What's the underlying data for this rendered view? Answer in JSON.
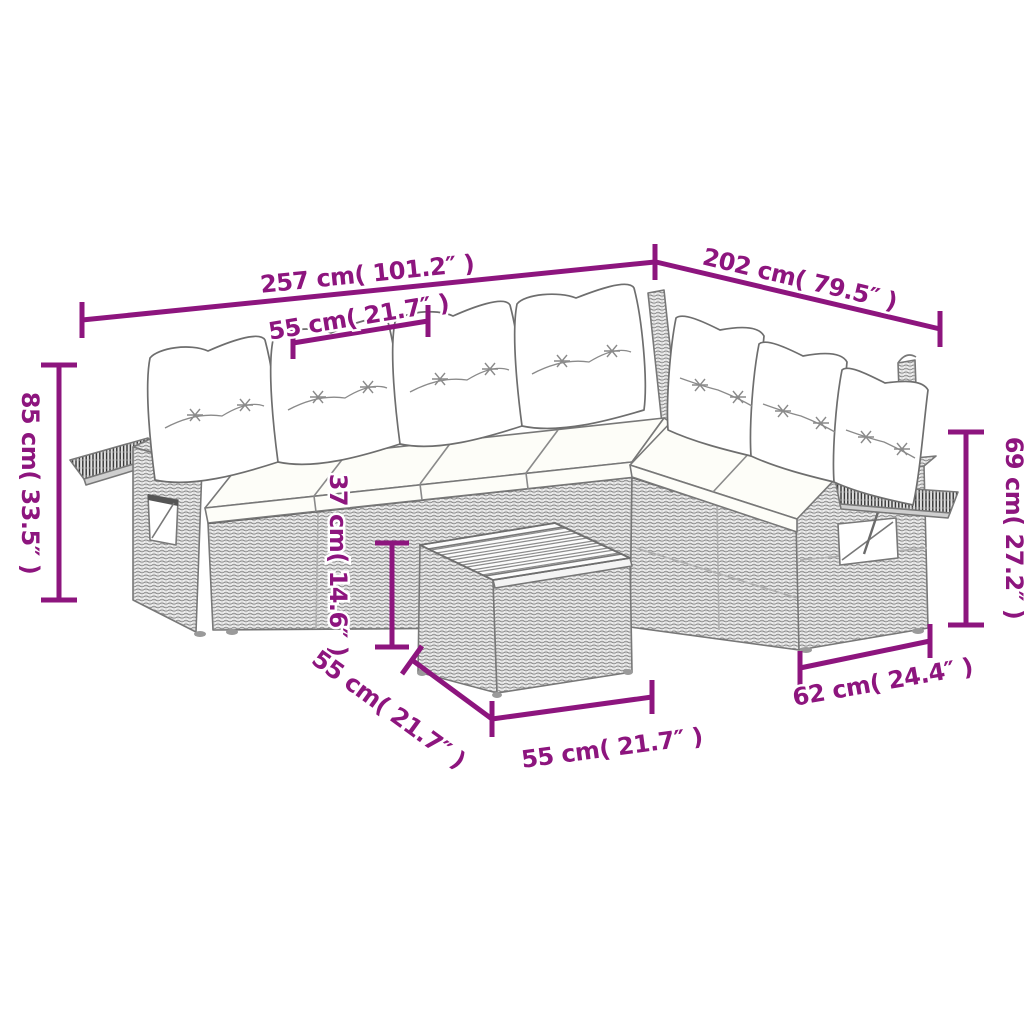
{
  "illustration": {
    "name": "rattan-corner-sofa-set-with-cushions-and-wood-top-ottoman",
    "style": "technical line drawing, gray weave texture, white cushions",
    "accent_color": "#8d157e",
    "outline_color": "#787878"
  },
  "dimensions": {
    "sofa_total_length_left": {
      "label": "257 cm( 101.2″ )"
    },
    "sofa_total_length_right": {
      "label": "202 cm( 79.5″ )"
    },
    "seat_module_width": {
      "label": "55 cm( 21.7″ )"
    },
    "sofa_overall_height": {
      "label": "85 cm( 33.5″ )"
    },
    "armrest_height": {
      "label": "69 cm( 27.2″ )"
    },
    "seat_height": {
      "label": "37 cm( 14.6″ )"
    },
    "ottoman_depth": {
      "label": "55 cm( 21.7″ )"
    },
    "ottoman_width": {
      "label": "55 cm( 21.7″ )"
    },
    "arm_module_depth": {
      "label": "62 cm( 24.4″ )"
    }
  }
}
